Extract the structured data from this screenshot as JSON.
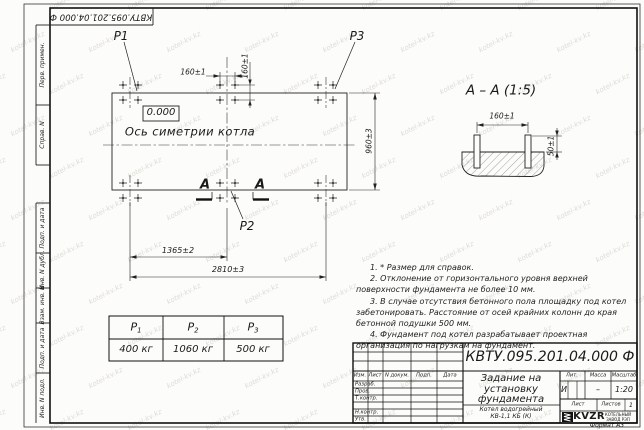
{
  "watermark": {
    "text": "kotel-kv.kz"
  },
  "frame": {
    "corner_designation": "КВТУ.095.201.04.000  Ф",
    "left_strip": [
      "Перв. примен.",
      "Справ. N",
      "Подп. и дата",
      "Инв. N дубл.",
      "Взам. инв. N",
      "Подп. и дата",
      "Инв. N подл."
    ],
    "format_label": "Формат А3"
  },
  "plan": {
    "labels": {
      "p1": "P1",
      "p2": "P2",
      "p3": "P3",
      "elevation": "0.000",
      "axis": "Ось симетрии котла",
      "section_letter": "А"
    },
    "dimensions": {
      "bolt_spacing_x": "160±1",
      "bolt_spacing_y": "160±1",
      "width_left": "1365±2",
      "width_total": "2810±3",
      "height": "960±3"
    }
  },
  "section": {
    "title": "А – А (1:5)",
    "dimensions": {
      "bolt_spacing": "160±1",
      "bolt_protrusion": "50±1"
    }
  },
  "notes": {
    "items": [
      "1. * Размер для справок.",
      "2. Отклонение от горизонтального уровня верхней поверхности фундамента не более 10 мм.",
      "3. В случае отсутствия бетонного пола площадку под котел забетонировать. Расстояние от осей крайних колонн до края бетонной подушки 500 мм.",
      "4. Фундамент под котел разрабатывает проектная организация по нагрузкам на фундамент."
    ]
  },
  "loads_table": {
    "headers": [
      {
        "base": "P",
        "sub": "1"
      },
      {
        "base": "P",
        "sub": "2"
      },
      {
        "base": "P",
        "sub": "3"
      }
    ],
    "values": [
      "400 кг",
      "1060 кг",
      "500 кг"
    ]
  },
  "title_block": {
    "designation": "КВТУ.095.201.04.000  Ф",
    "doc_title_lines": [
      "Задание на",
      "установку",
      "фундамента"
    ],
    "product_lines": [
      "Котел водогрейный",
      "КВ-1,1 КБ (К)"
    ],
    "header_cols": [
      "Изм.",
      "Лист",
      "N докум.",
      "Подп.",
      "Дата"
    ],
    "sign_rows": [
      "Разраб.",
      "Пров.",
      "Т.контр.",
      "",
      "Н.контр.",
      "Утв."
    ],
    "lit_label": "Лит.",
    "mass_label": "Масса",
    "scale_label": "Масштаб",
    "lit_value": "И",
    "mass_value": "–",
    "scale_value": "1:20",
    "sheet_label": "Лист",
    "sheets_label": "Листов",
    "sheets_value": "1",
    "logo_text": "KVZR",
    "logo_caption": [
      "КОТЕЛЬНЫЙ",
      "ЗАВОД РЭП"
    ]
  }
}
